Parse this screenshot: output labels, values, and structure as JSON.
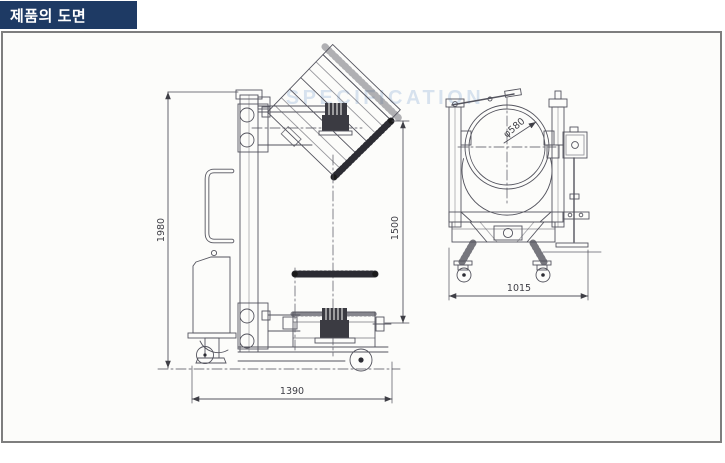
{
  "header": {
    "title": "제품의 도면",
    "bg_color": "#1e3a64",
    "text_color": "#ffffff"
  },
  "panel": {
    "border_color": "#7e7e7e",
    "bg_color": "#fcfcfa"
  },
  "watermark": {
    "text": "SPECIFICATION",
    "color": "#b9cde6"
  },
  "drawing": {
    "line_color": "#54545e",
    "dark_color": "#2c2c33",
    "side_view": {
      "dim_overall_height": "1980",
      "dim_lift_height": "1500",
      "dim_base_length": "1390"
    },
    "front_view": {
      "dim_frame_width": "1015",
      "dim_drum_diameter": "φ580"
    }
  }
}
